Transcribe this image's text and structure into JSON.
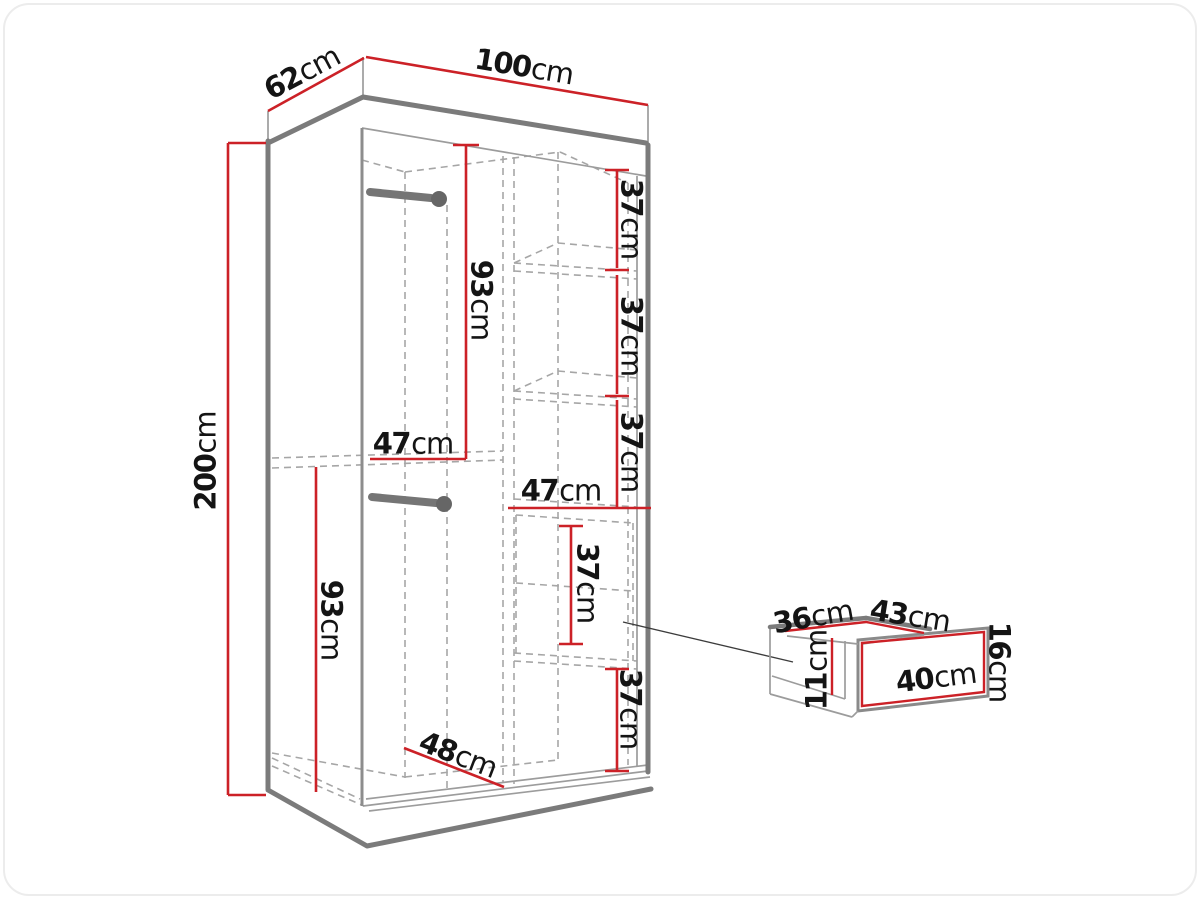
{
  "figure": {
    "type": "furniture-dimension-diagram",
    "subject": "Two-door sliding wardrobe with shelves, two hanging rails and a pull-out drawer detail"
  },
  "colors": {
    "dimension_red": "#cc2127",
    "edge_gray": "#7b7b7b",
    "line_gray": "#9c9c9c",
    "dashed_gray": "#a6a6a6",
    "rail_gray": "#757575",
    "text": "#141414",
    "background": "#ffffff",
    "card_border": "#ececec"
  },
  "dimensions": {
    "wardrobe": {
      "height": "200 cm",
      "width": "100 cm",
      "depth": "62 cm",
      "hanging_section_heights": [
        "93 cm",
        "93 cm"
      ],
      "section_widths": [
        "47 cm",
        "47 cm"
      ],
      "shelf_spacings": [
        "37 cm",
        "37 cm",
        "37 cm",
        "37 cm",
        "37 cm"
      ],
      "floor_diagonal_depth": "48 cm"
    },
    "drawer": {
      "top_left_edge": "36 cm",
      "top_right_edge": "43 cm",
      "front_width": "40 cm",
      "front_height": "16 cm",
      "inner_depth": "11 cm"
    }
  },
  "labels": {
    "d62": {
      "value": "62",
      "unit": "cm"
    },
    "d100": {
      "value": "100",
      "unit": "cm"
    },
    "d200": {
      "value": "200",
      "unit": "cm"
    },
    "d93a": {
      "value": "93",
      "unit": "cm"
    },
    "d47a": {
      "value": "47",
      "unit": "cm"
    },
    "d93b": {
      "value": "93",
      "unit": "cm"
    },
    "d47b": {
      "value": "47",
      "unit": "cm"
    },
    "d37a": {
      "value": "37",
      "unit": "cm"
    },
    "d37b": {
      "value": "37",
      "unit": "cm"
    },
    "d37c": {
      "value": "37",
      "unit": "cm"
    },
    "d37m": {
      "value": "37",
      "unit": "cm"
    },
    "d37d": {
      "value": "37",
      "unit": "cm"
    },
    "d48": {
      "value": "48",
      "unit": "cm"
    },
    "d36": {
      "value": "36",
      "unit": "cm"
    },
    "d43": {
      "value": "43",
      "unit": "cm"
    },
    "d16": {
      "value": "16",
      "unit": "cm"
    },
    "d40": {
      "value": "40",
      "unit": "cm"
    },
    "d11": {
      "value": "11",
      "unit": "cm"
    }
  }
}
